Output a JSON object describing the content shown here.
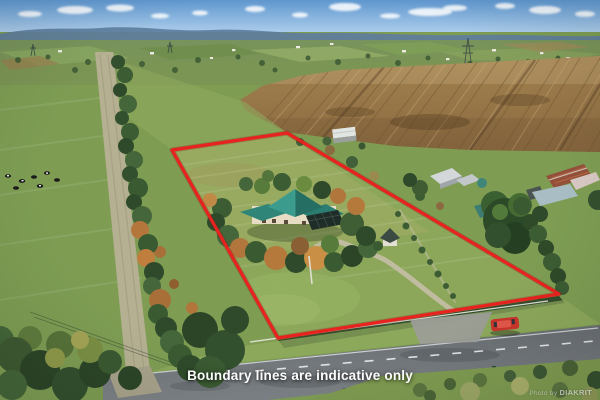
{
  "image": {
    "kind": "aerial-photograph",
    "subject": "rural lifestyle property with red boundary outline"
  },
  "overlay": {
    "disclaimer": "Boundary lines are indicative only"
  },
  "watermark": {
    "prefix": "Photo by",
    "brand": "DIAKRIT"
  },
  "boundary": {
    "color": "#e8231f",
    "stroke_width": "3.2",
    "points": "172,150 287,133 559,294 278,338"
  },
  "scene": {
    "palette": {
      "sky": "#7fb0dd",
      "distant_hills": "#5e7e9d",
      "grass": "#7e9d53",
      "plowed_field": "#96754a",
      "house_roof_teal": "#2f8578",
      "road": "#70757a",
      "red_car": "#c8352b",
      "overlay_text": "#ffffff"
    },
    "elements": [
      "sky-with-clouds",
      "distant-hills",
      "far-farmland",
      "plowed-field",
      "tree-lined-lane",
      "cattle",
      "shelterbelt-trees",
      "farmhouse-teal-roof",
      "conservatory",
      "garden-trees",
      "small-cabin",
      "white-field-shed",
      "neighbour-sheds",
      "rusty-barn",
      "big-tree",
      "driveway",
      "hedge-row",
      "white-road-fence",
      "road",
      "red-car",
      "dark-car",
      "grass-verge"
    ]
  }
}
